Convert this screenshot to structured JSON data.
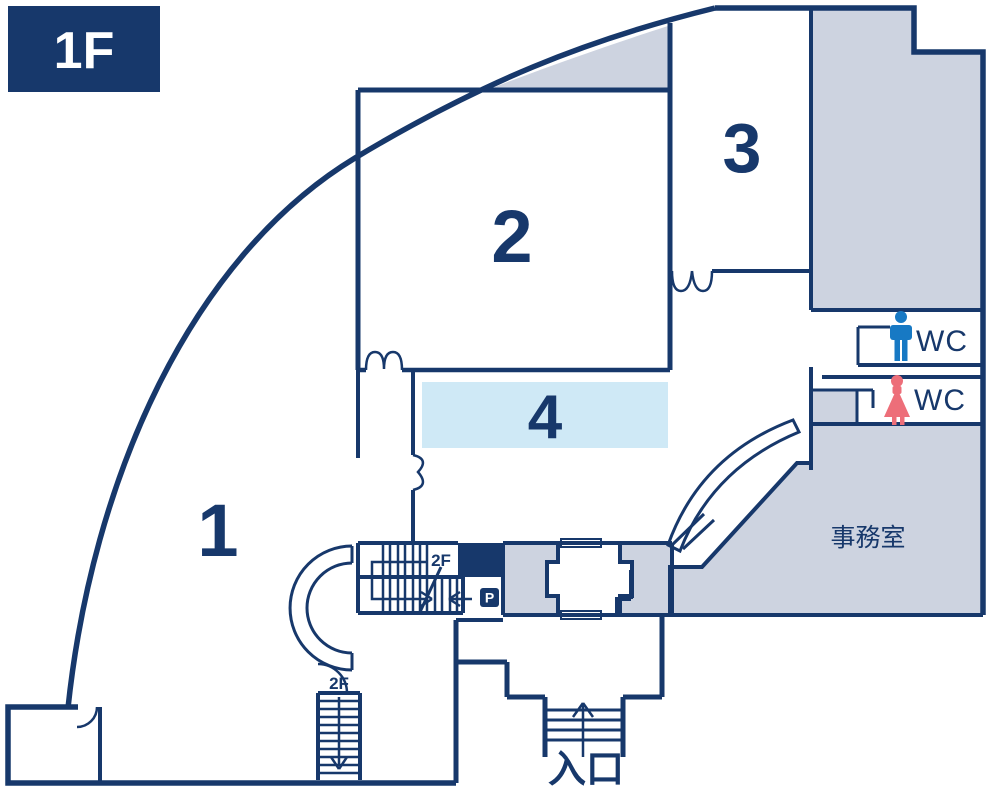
{
  "floor_badge": {
    "label": "1F"
  },
  "rooms": {
    "room1": {
      "number": "1"
    },
    "room2": {
      "number": "2"
    },
    "room3": {
      "number": "3"
    },
    "room4": {
      "number": "4"
    },
    "office": {
      "label": "事務室"
    }
  },
  "wc": {
    "men": {
      "label": "WC",
      "icon": "male-icon"
    },
    "women": {
      "label": "WC",
      "icon": "female-icon"
    }
  },
  "entrance": {
    "label": "入口"
  },
  "stairs": {
    "mid": {
      "label": "2F"
    },
    "bottom": {
      "label": "2F"
    }
  },
  "p_badge": {
    "label": "P"
  },
  "colors": {
    "wall_navy": "#17386b",
    "area_gray": "#cdd3e0",
    "room4_blue": "#cfe9f6",
    "wc_male_blue": "#1779c4",
    "wc_female_pink": "#ed6e79"
  }
}
